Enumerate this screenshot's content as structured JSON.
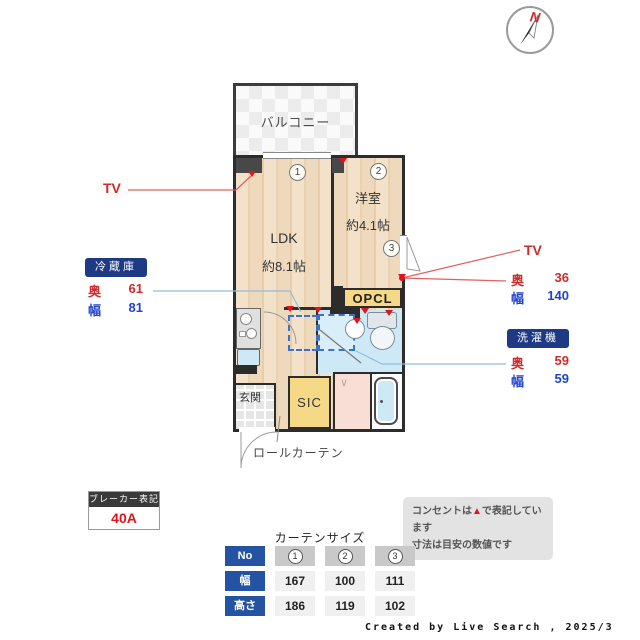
{
  "compass": {
    "label": "N"
  },
  "plan": {
    "balcony_label": "バルコニー",
    "ldk": {
      "name": "LDK",
      "size": "約8.1帖"
    },
    "bedroom": {
      "name": "洋室",
      "size": "約4.1帖"
    },
    "opcl_label": "OPCL",
    "sic_label": "SIC",
    "genkan_label": "玄関",
    "roll_curtain_label": "ロールカーテン",
    "markers": [
      "1",
      "2",
      "3"
    ]
  },
  "annotations": {
    "tv_left": "TV",
    "tv_right": "TV",
    "fridge": {
      "label": "冷蔵庫",
      "depth_label": "奥",
      "depth": "61",
      "width_label": "幅",
      "width": "81"
    },
    "tv_size": {
      "depth_label": "奥",
      "depth": "36",
      "width_label": "幅",
      "width": "140"
    },
    "washer": {
      "label": "洗濯機",
      "depth_label": "奥",
      "depth": "59",
      "width_label": "幅",
      "width": "59"
    },
    "breaker": {
      "label": "ブレーカー表記",
      "value": "40A"
    },
    "note": {
      "line1_pre": "コンセントは",
      "line1_marker": "▲",
      "line1_post": "で表記しています",
      "line2": "寸法は目安の数値です"
    }
  },
  "curtain_table": {
    "title": "カーテンサイズ",
    "row_headers": [
      "No",
      "幅",
      "高さ"
    ],
    "columns": [
      "1",
      "2",
      "3"
    ],
    "width_values": [
      "167",
      "100",
      "111"
    ],
    "height_values": [
      "186",
      "119",
      "102"
    ]
  },
  "credit": "Created by Live Search , 2025/3",
  "colors": {
    "accent_red": "#e1131d",
    "value_blue": "#2244cc",
    "badge_navy": "#1f3a85",
    "table_blue": "#2353a2",
    "floor_tan": "#f3e1ca",
    "water_blue": "#cde9f5",
    "closet_yellow": "#f6d987",
    "wall_dark": "#2c2c2c"
  }
}
